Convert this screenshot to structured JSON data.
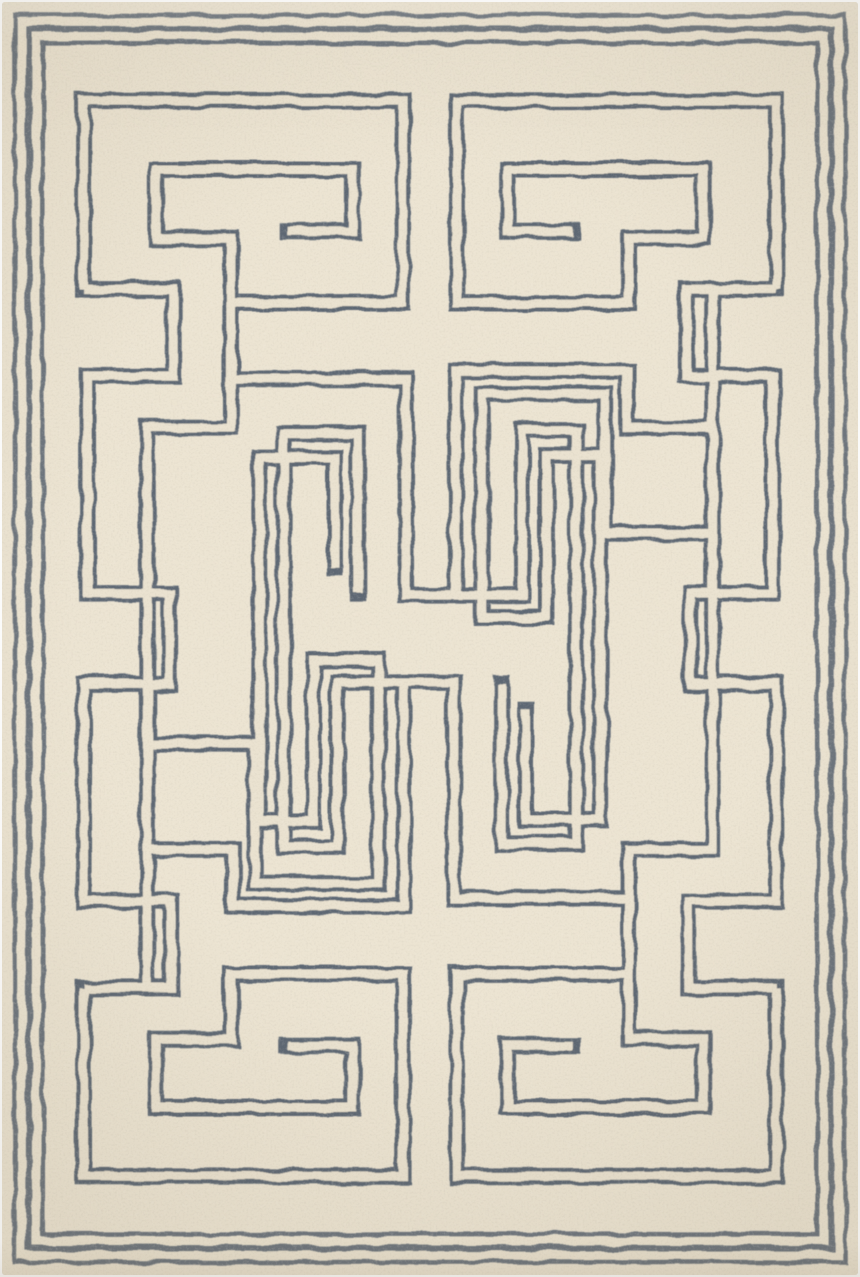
{
  "meta": {
    "subject": "Hand-tufted wool area rug: cream ground with slate blue-gray double-line Greek key maze pattern and triple-line border",
    "orientation": "portrait"
  },
  "rug": {
    "canvas": {
      "width": 860,
      "height": 1277
    },
    "colors": {
      "page_bg": "#ffffff",
      "ground": "#ece4d2",
      "mottle": "#d7c5a5",
      "speckle": "#6e6757",
      "line": "#55606e",
      "line_gap": "#eae2d0"
    },
    "border": {
      "insets": [
        13,
        27,
        41
      ],
      "widths": [
        4.5,
        6,
        4.5
      ]
    },
    "maze": {
      "band_width": 17,
      "gap_width": 9,
      "lines": {
        "spiral_top_left": [
          [
            82,
            288
          ],
          [
            82,
            99
          ],
          [
            403,
            99
          ],
          [
            403,
            302
          ],
          [
            230,
            302
          ],
          [
            230,
            237
          ],
          [
            155,
            237
          ],
          [
            155,
            168
          ],
          [
            352,
            168
          ],
          [
            352,
            230
          ],
          [
            287,
            230
          ]
        ],
        "spiral_top_right": [
          [
            778,
            288
          ],
          [
            778,
            99
          ],
          [
            457,
            99
          ],
          [
            457,
            302
          ],
          [
            630,
            302
          ],
          [
            630,
            237
          ],
          [
            705,
            237
          ],
          [
            705,
            168
          ],
          [
            508,
            168
          ],
          [
            508,
            230
          ],
          [
            573,
            230
          ]
        ],
        "spiral_bottom_left": [
          [
            82,
            989
          ],
          [
            82,
            1178
          ],
          [
            403,
            1178
          ],
          [
            403,
            975
          ],
          [
            230,
            975
          ],
          [
            230,
            1040
          ],
          [
            155,
            1040
          ],
          [
            155,
            1109
          ],
          [
            352,
            1109
          ],
          [
            352,
            1047
          ],
          [
            287,
            1047
          ]
        ],
        "spiral_bottom_right": [
          [
            778,
            989
          ],
          [
            778,
            1178
          ],
          [
            457,
            1178
          ],
          [
            457,
            975
          ],
          [
            630,
            975
          ],
          [
            630,
            1040
          ],
          [
            705,
            1040
          ],
          [
            705,
            1109
          ],
          [
            508,
            1109
          ],
          [
            508,
            1047
          ],
          [
            573,
            1047
          ]
        ],
        "rail_left": [
          [
            82,
            288
          ],
          [
            172,
            288
          ],
          [
            172,
            375
          ],
          [
            86,
            375
          ],
          [
            86,
            593
          ],
          [
            168,
            593
          ],
          [
            168,
            684
          ],
          [
            82,
            684
          ],
          [
            82,
            902
          ],
          [
            170,
            902
          ],
          [
            170,
            989
          ],
          [
            82,
            989
          ]
        ],
        "rail_right": [
          [
            778,
            288
          ],
          [
            688,
            288
          ],
          [
            688,
            375
          ],
          [
            774,
            375
          ],
          [
            774,
            593
          ],
          [
            692,
            593
          ],
          [
            692,
            684
          ],
          [
            778,
            684
          ],
          [
            778,
            902
          ],
          [
            690,
            902
          ],
          [
            690,
            989
          ],
          [
            778,
            989
          ]
        ],
        "stair_left": [
          [
            230,
            302
          ],
          [
            230,
            427
          ],
          [
            146,
            427
          ],
          [
            146,
            989
          ]
        ],
        "stair_right": [
          [
            630,
            975
          ],
          [
            630,
            850
          ],
          [
            714,
            850
          ],
          [
            714,
            288
          ]
        ],
        "meander_upper_left": [
          [
            230,
            302
          ],
          [
            230,
            378
          ],
          [
            406,
            378
          ],
          [
            406,
            595
          ],
          [
            523,
            595
          ],
          [
            523,
            430
          ],
          [
            577,
            430
          ],
          [
            577,
            844
          ],
          [
            502,
            844
          ],
          [
            502,
            684
          ]
        ],
        "meander_lower_right": [
          [
            630,
            975
          ],
          [
            630,
            899
          ],
          [
            454,
            899
          ],
          [
            454,
            682
          ],
          [
            337,
            682
          ],
          [
            337,
            847
          ],
          [
            283,
            847
          ],
          [
            283,
            433
          ],
          [
            358,
            433
          ],
          [
            358,
            593
          ]
        ],
        "arch_top_outer": [
          [
            714,
            427
          ],
          [
            628,
            427
          ],
          [
            628,
            370
          ],
          [
            456,
            370
          ],
          [
            456,
            595
          ]
        ],
        "arch_bottom_outer": [
          [
            146,
            850
          ],
          [
            232,
            850
          ],
          [
            232,
            907
          ],
          [
            404,
            907
          ],
          [
            404,
            682
          ]
        ],
        "arch_top_inner": [
          [
            714,
            533
          ],
          [
            606,
            533
          ],
          [
            606,
            393
          ],
          [
            482,
            393
          ],
          [
            482,
            617
          ],
          [
            547,
            617
          ],
          [
            547,
            455
          ],
          [
            601,
            455
          ],
          [
            601,
            820
          ],
          [
            526,
            820
          ],
          [
            526,
            710
          ]
        ],
        "arch_bottom_inner": [
          [
            146,
            744
          ],
          [
            254,
            744
          ],
          [
            254,
            884
          ],
          [
            378,
            884
          ],
          [
            378,
            660
          ],
          [
            313,
            660
          ],
          [
            313,
            822
          ],
          [
            259,
            822
          ],
          [
            259,
            457
          ],
          [
            334,
            457
          ],
          [
            334,
            567
          ]
        ]
      }
    }
  }
}
